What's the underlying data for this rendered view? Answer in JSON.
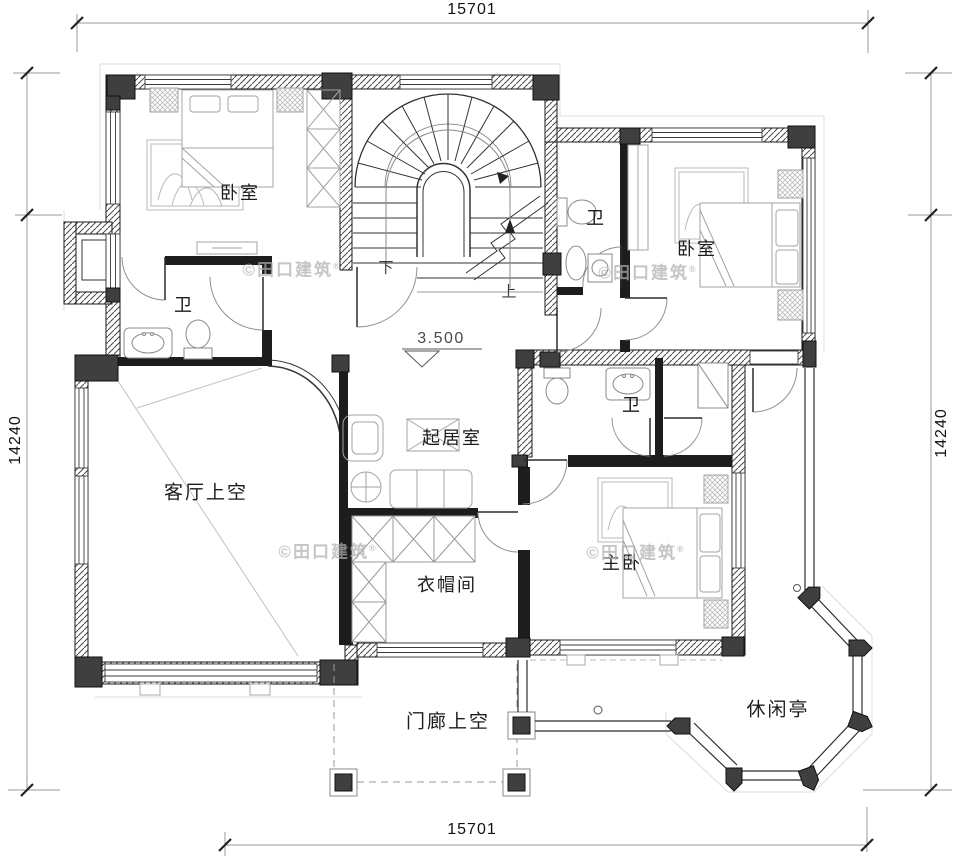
{
  "dimensions": {
    "top": "15701",
    "bottom": "15701",
    "left": "14240",
    "right": "14240"
  },
  "rooms": [
    {
      "id": "bedroom-left",
      "label": "卧室"
    },
    {
      "id": "bath-left",
      "label": "卫"
    },
    {
      "id": "bath-top-right",
      "label": "卫"
    },
    {
      "id": "bedroom-right",
      "label": "卧室"
    },
    {
      "id": "sitting-room",
      "label": "起居室"
    },
    {
      "id": "bath-middle",
      "label": "卫"
    },
    {
      "id": "living-void",
      "label": "客厅上空"
    },
    {
      "id": "cloakroom",
      "label": "衣帽间"
    },
    {
      "id": "master-bedroom",
      "label": "主卧"
    },
    {
      "id": "porch-void",
      "label": "门廊上空"
    },
    {
      "id": "pavilion",
      "label": "休闲亭"
    }
  ],
  "stairs": {
    "up": "上",
    "down": "下"
  },
  "elevation": {
    "value": "3.500"
  },
  "watermark": {
    "text": "©田口建筑",
    "registered": "®"
  },
  "colors": {
    "wall": "#1d1d1d",
    "corner_block": "#3f3f3f",
    "furniture_line": "#9a9a9a",
    "watermark": "#b0b0b0"
  }
}
